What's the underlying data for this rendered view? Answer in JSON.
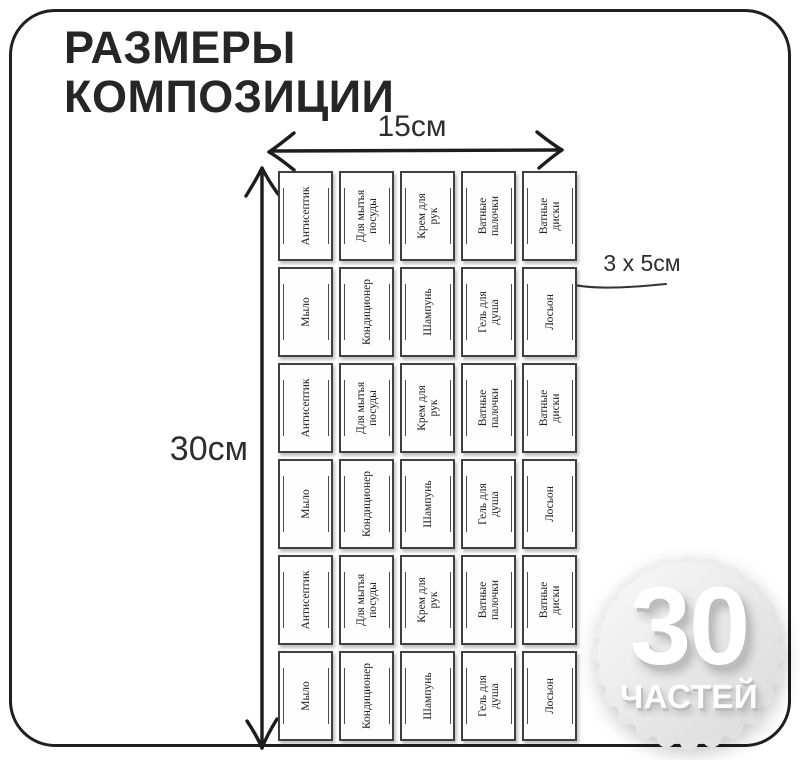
{
  "title": {
    "text": "РАЗМЕРЫ\nКОМПОЗИЦИИ"
  },
  "dimensions": {
    "width_label": "15см",
    "height_label": "30см",
    "cell_label": "3 х 5см"
  },
  "badge": {
    "number": "30",
    "caption": "ЧАСТЕЙ"
  },
  "grid": {
    "rows": [
      {
        "cells": [
          "Антисептик",
          "Для мытья\nпосуды",
          "Крем для\nрук",
          "Ватные\nпалочки",
          "Ватные\nдиски"
        ]
      },
      {
        "cells": [
          "Мыло",
          "Кондиционер",
          "Шампунь",
          "Гель для\nдуша",
          "Лосьон"
        ]
      },
      {
        "cells": [
          "Антисептик",
          "Для мытья\nпосуды",
          "Крем для\nрук",
          "Ватные\nпалочки",
          "Ватные\nдиски"
        ]
      },
      {
        "cells": [
          "Мыло",
          "Кондиционер",
          "Шампунь",
          "Гель для\nдуша",
          "Лосьон"
        ]
      },
      {
        "cells": [
          "Антисептик",
          "Для мытья\nпосуды",
          "Крем для\nрук",
          "Ватные\nпалочки",
          "Ватные\nдиски"
        ]
      },
      {
        "cells": [
          "Мыло",
          "Кондиционер",
          "Шампунь",
          "Гель для\nдуша",
          "Лосьон"
        ]
      }
    ]
  },
  "colors": {
    "frame_border": "#1f1f1f",
    "title_text": "#262626",
    "card_border": "#404040",
    "arrow": "#1d1d1d",
    "badge_fill_light": "#fafafa",
    "badge_fill_dark": "#d9d9d9",
    "badge_text": "#ffffff"
  }
}
